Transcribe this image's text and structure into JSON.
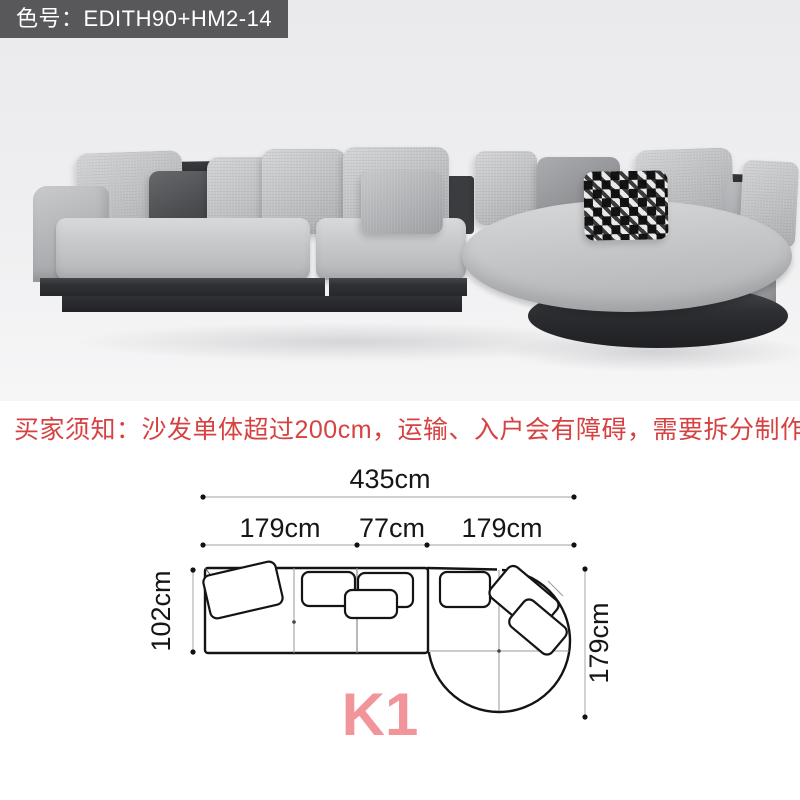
{
  "badge": {
    "label": "色号：EDITH90+HM2-14",
    "bg": "#58585a",
    "fg": "#ffffff"
  },
  "notice": {
    "text": "买家须知：沙发单体超过200cm，运输、入户会有障碍，需要拆分制作",
    "color": "#d64242"
  },
  "diagram": {
    "total_width_label": "435cm",
    "segment_labels": [
      "179cm",
      "77cm",
      "179cm"
    ],
    "left_depth_label": "102cm",
    "right_depth_label": "179cm",
    "model_label": "K1",
    "model_color": "#f2959b",
    "outline_color": "#141414"
  },
  "colors": {
    "photo_bg": "#efeff1",
    "sofa_fabric": "#c2c3c6",
    "sofa_base": "#323335",
    "dark_pillow": "#55565a",
    "houndstooth_black": "#141414",
    "houndstooth_white": "#e9e9ea"
  }
}
